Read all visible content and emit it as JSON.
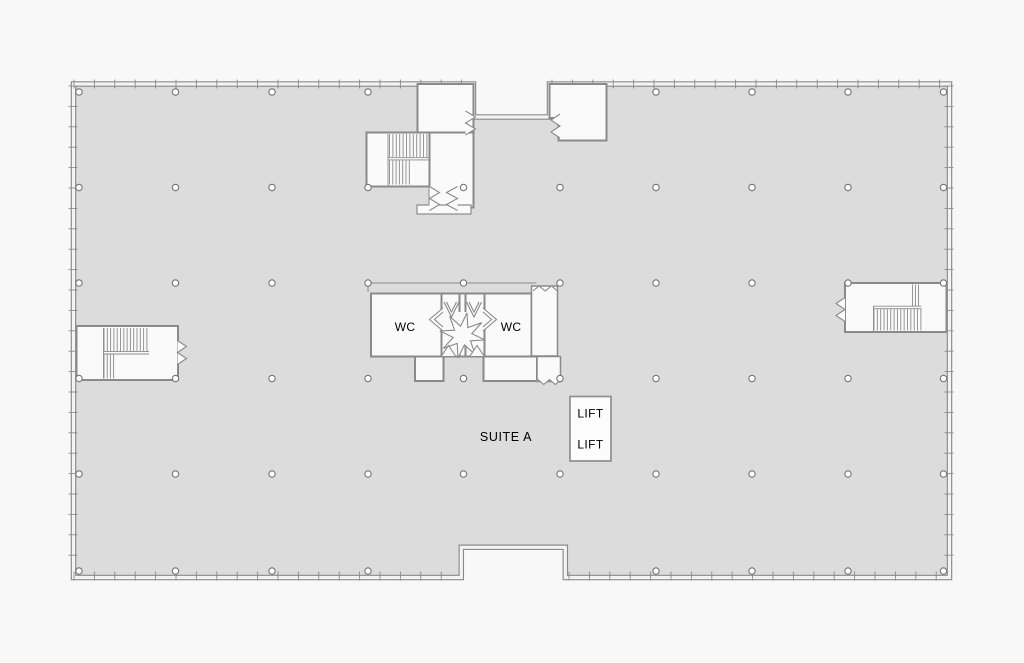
{
  "plan": {
    "suite_label": "SUITE A",
    "rooms": {
      "wc_left": "WC",
      "wc_right": "WC"
    },
    "lifts": [
      "LIFT",
      "LIFT"
    ],
    "features": {
      "column_grid": {
        "columns": 10,
        "rows": 6
      },
      "stair_cores": 3,
      "lift_shafts": 2,
      "top_entrance_recess": true,
      "bottom_recess": true
    },
    "colors": {
      "background": "#f8f8f8",
      "floor": "#dcdcdd",
      "wall_line": "#8a8a8a",
      "wall_core": "#f4f4f4",
      "room_fill": "#fafafa",
      "text": "#000000"
    }
  }
}
